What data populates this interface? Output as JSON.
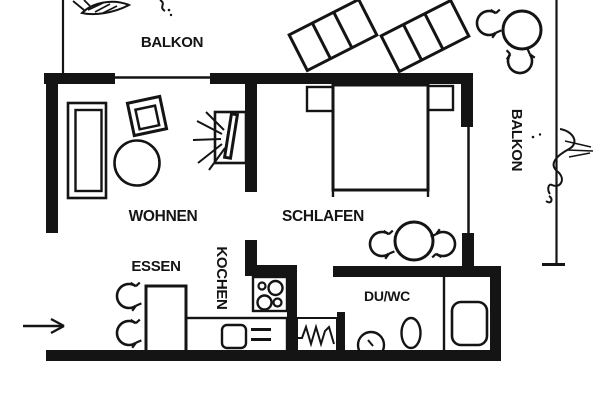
{
  "plan": {
    "type": "apartment-floor-plan",
    "labels": {
      "balkon_top": "BALKON",
      "wohnen": "WOHNEN",
      "schlafen": "SCHLAFEN",
      "essen": "ESSEN",
      "kochen": "KOCHEN",
      "duwc": "DU/WC",
      "balkon_right": "BALKON"
    },
    "colors": {
      "ink": "#141414",
      "paper": "#ffffff"
    },
    "symbols": [
      "sofa",
      "armchair",
      "coffee-table",
      "tv",
      "bed",
      "nightstand",
      "round-dining-table",
      "chair-rotation-arrow",
      "dining-table",
      "kitchen-counter",
      "sink",
      "stove-hob",
      "radiator-zigzag",
      "washbasin",
      "toilet",
      "shower-tray",
      "sun-lounger",
      "balcony-table",
      "plant-sketch",
      "entrance-arrow",
      "window-line",
      "balcony-railing"
    ]
  }
}
